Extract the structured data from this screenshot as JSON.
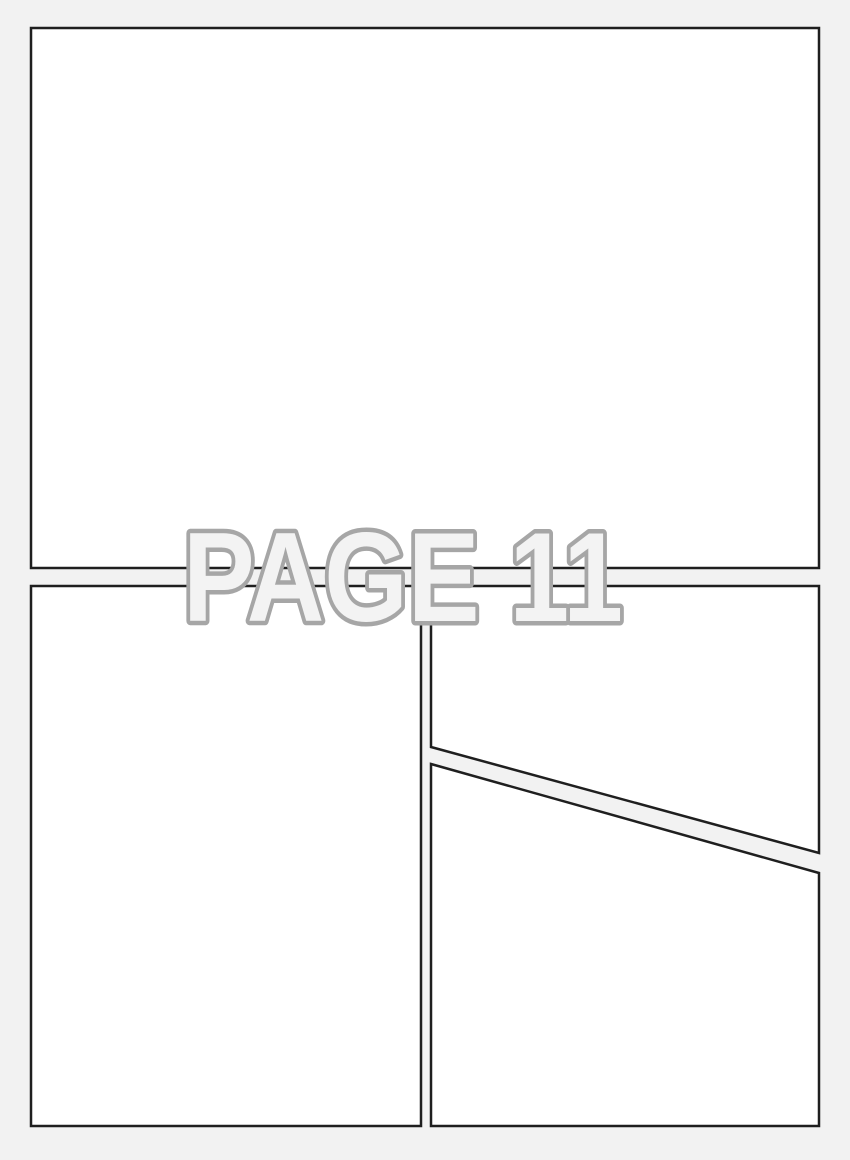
{
  "watermark": {
    "label": "PAGE 11"
  },
  "panels": [
    {
      "name": "top-full-width",
      "shape": "rectangle",
      "content": ""
    },
    {
      "name": "bottom-left",
      "shape": "rectangle",
      "content": ""
    },
    {
      "name": "bottom-right-upper",
      "shape": "diagonal-cut-quadrilateral",
      "content": ""
    },
    {
      "name": "bottom-right-lower",
      "shape": "diagonal-cut-quadrilateral",
      "content": ""
    }
  ],
  "colors": {
    "page_background": "#f2f2f2",
    "panel_fill": "#ffffff",
    "panel_border": "#1f1f1f",
    "watermark_stroke": "#a6a6a6",
    "watermark_fill": "#f3f3f3"
  }
}
